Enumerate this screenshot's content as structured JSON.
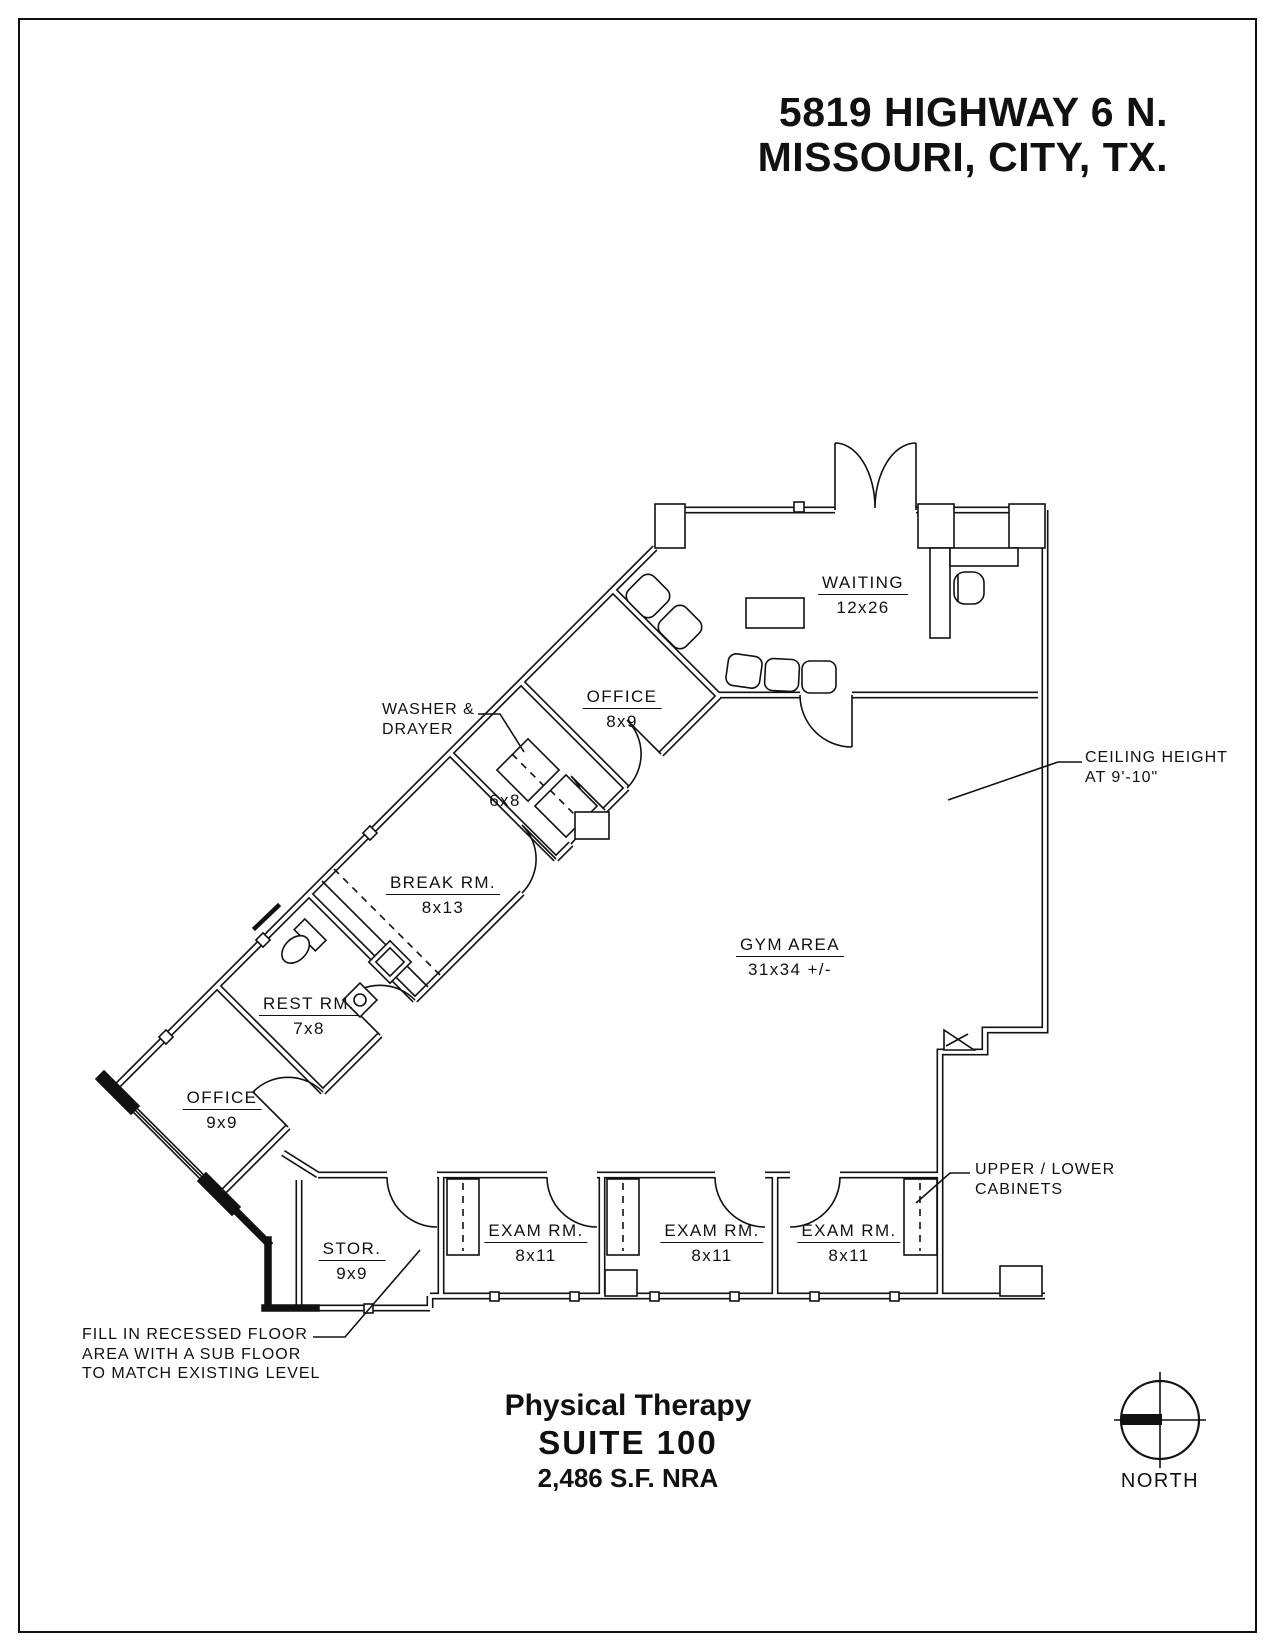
{
  "page": {
    "title_line1": "5819 HIGHWAY 6 N.",
    "title_line2": "MISSOURI, CITY, TX.",
    "footer": {
      "project": "Physical Therapy",
      "suite": "SUITE  100",
      "area": "2,486 S.F. NRA"
    },
    "compass_label": "NORTH"
  },
  "rooms": {
    "waiting": {
      "name": "WAITING",
      "dim": "12x26"
    },
    "office_top": {
      "name": "OFFICE",
      "dim": "8x9"
    },
    "laundry": {
      "dim": "6x8"
    },
    "break_room": {
      "name": "BREAK  RM.",
      "dim": "8x13"
    },
    "rest_room": {
      "name": "REST  RM.",
      "dim": "7x8"
    },
    "office_lower": {
      "name": "OFFICE",
      "dim": "9x9"
    },
    "storage": {
      "name": "STOR.",
      "dim": "9x9"
    },
    "exam1": {
      "name": "EXAM  RM.",
      "dim": "8x11"
    },
    "exam2": {
      "name": "EXAM  RM.",
      "dim": "8x11"
    },
    "exam3": {
      "name": "EXAM  RM.",
      "dim": "8x11"
    },
    "gym": {
      "name": "GYM  AREA",
      "dim": "31x34 +/-"
    }
  },
  "annotations": {
    "washer": "WASHER &\nDRAYER",
    "ceiling": "CEILING HEIGHT\nAT 9'-10\"",
    "cabinets": "UPPER / LOWER\nCABINETS",
    "recessed_floor": "FILL IN RECESSED FLOOR\nAREA WITH A SUB FLOOR\nTO MATCH EXISTING LEVEL"
  }
}
